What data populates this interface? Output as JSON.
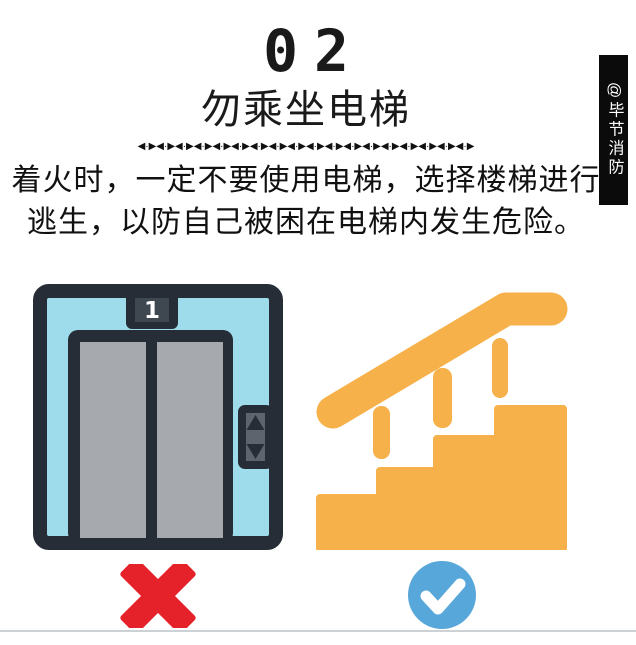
{
  "header": {
    "step_number": "02",
    "title": "勿乘坐电梯",
    "divider": "◀·▶◀·▶◀·▶◀·▶◀·▶◀·▶◀·▶◀·▶◀·▶◀·▶◀·▶◀·▶◀·▶◀·▶◀·▶◀·▶◀·▶◀·▶",
    "desc_line1": "着火时，一定不要使用电梯，选择楼梯进行",
    "desc_line2": "逃生，以防自己被困在电梯内发生危险。"
  },
  "watermark": {
    "handle": "@毕节消防"
  },
  "elevator": {
    "floor_label": "1"
  },
  "colors": {
    "text": "#1a1a1a",
    "banner_bg": "#0b0b0b",
    "elevator_frame": "#262d36",
    "elevator_cab_blue": "#9edceb",
    "door_gray": "#a6a9ae",
    "indicator_inner": "#3f4750",
    "button_inner_gray": "#5d646d",
    "forbidden_red": "#e52129",
    "stairs_orange": "#f6b14a",
    "check_blue": "#58a7da",
    "bottom_rule": "#ccd1d5"
  }
}
